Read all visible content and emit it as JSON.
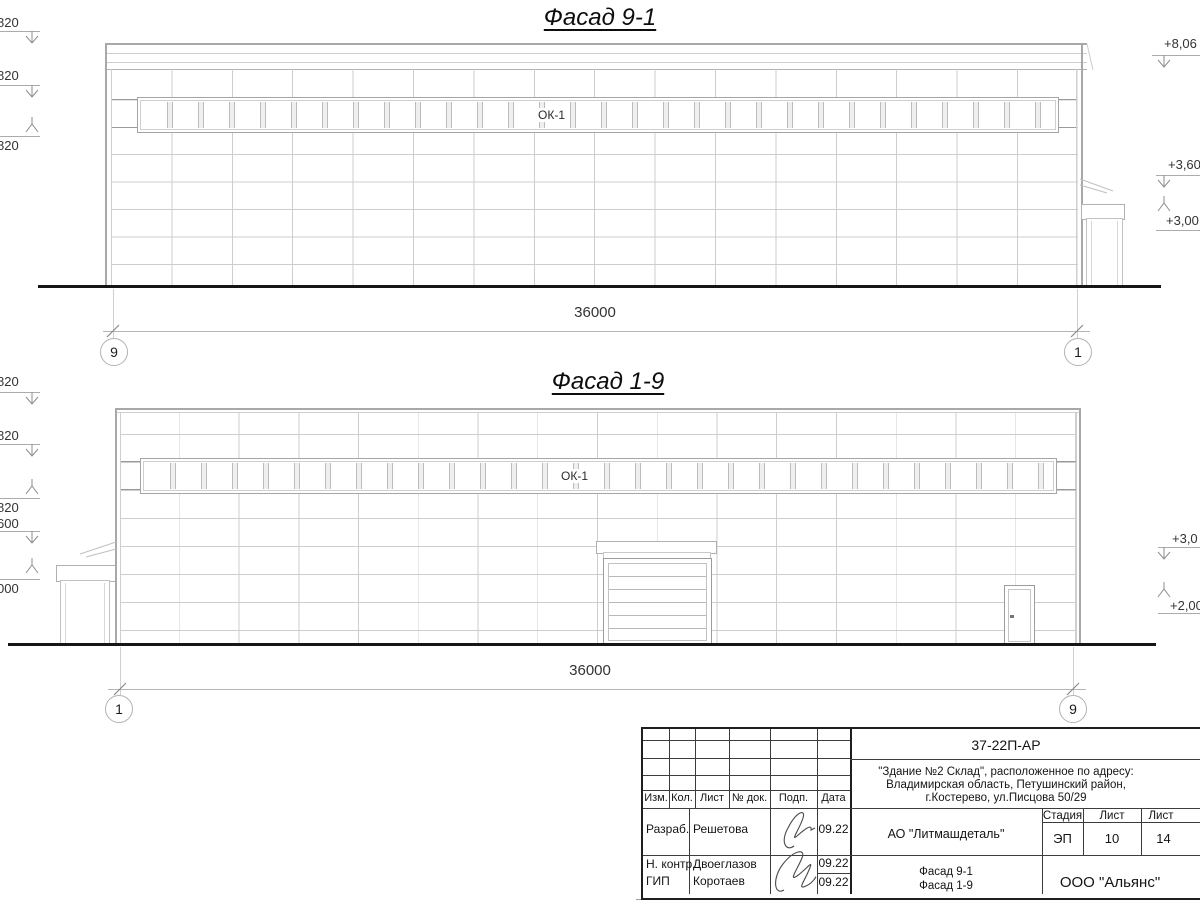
{
  "facades": [
    {
      "title": "Фасад 9-1",
      "window_label": "ОК-1",
      "dimension_total": "36000",
      "axis_start": "9",
      "axis_end": "1",
      "elevations_left": [
        "820",
        "820",
        "820"
      ],
      "elevations_right": [
        "+8,06",
        "+3,60",
        "+3,00"
      ]
    },
    {
      "title": "Фасад 1-9",
      "window_label": "ОК-1",
      "dimension_total": "36000",
      "axis_start": "1",
      "axis_end": "9",
      "elevations_left": [
        "820",
        "820",
        "820",
        "600",
        "000"
      ],
      "elevations_right": [
        "+3,0",
        "+2,00"
      ]
    }
  ],
  "title_block": {
    "doc_number": "37-22П-АР",
    "project_description": [
      "\"Здание №2 Склад\", расположенное по адресу:",
      "Владимирская область, Петушинский район,",
      "г.Костерево, ул.Писцова 50/29"
    ],
    "columns": [
      "Изм.",
      "Кол.",
      "Лист",
      "№ док.",
      "Подп.",
      "Дата"
    ],
    "signoff": [
      {
        "role": "Разраб.",
        "name": "Решетова",
        "date": "09.22"
      },
      {
        "role": "Н. контр.",
        "name": "Двоеглазов",
        "date": "09.22"
      },
      {
        "role": "ГИП",
        "name": "Коротаев",
        "date": "09.22"
      }
    ],
    "client": "АО \"Литмашдеталь\"",
    "stage_label": "Стадия",
    "sheet_label": "Лист",
    "sheets_label": "Лист",
    "stage": "ЭП",
    "sheet_number": "10",
    "sheets_total": "14",
    "sheet_title": [
      "Фасад 9-1",
      "Фасад 1-9"
    ],
    "organization": "ООО \"Альянс\""
  }
}
